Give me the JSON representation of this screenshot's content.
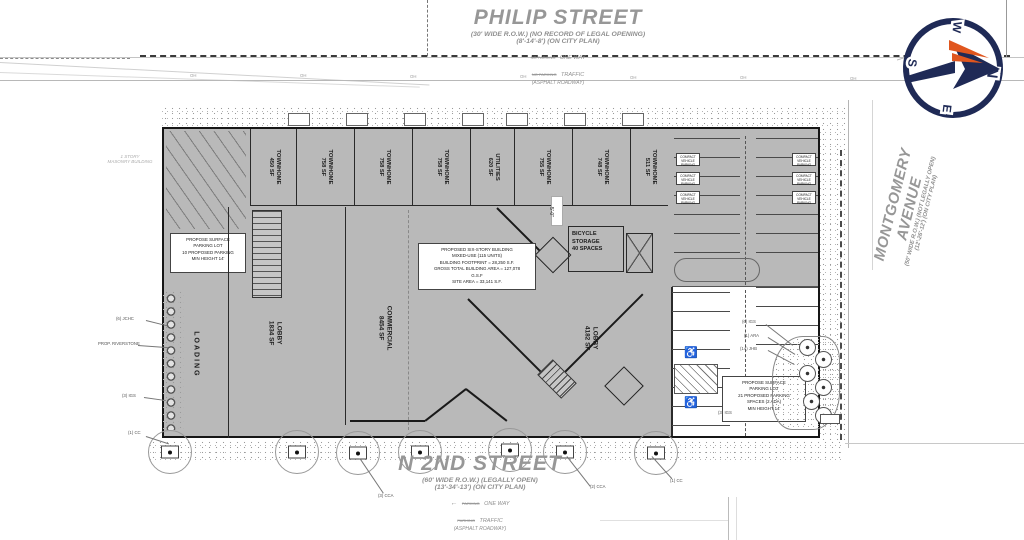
{
  "compass": {
    "n": "N",
    "e": "E",
    "s": "S",
    "w": "W"
  },
  "streets": {
    "philip": {
      "name": "PHILIP STREET",
      "row_note": "(30' WIDE R.O.W.) (NO RECORD OF LEGAL OPENING)",
      "plan_note": "(8'-14'-8') (ON CITY PLAN)",
      "parking_note_1": "NO PARKING",
      "dir_note_1": "ONE WAY",
      "parking_note_2": "NO PARKING",
      "dir_note_2": "TRAFFIC",
      "surface_note": "(ASPHALT ROADWAY)"
    },
    "n2nd": {
      "name": "N 2ND STREET",
      "row_note": "(60' WIDE R.O.W.) (LEGALLY OPEN)",
      "plan_note": "(13'-34'-13') (ON CITY PLAN)",
      "arrow": "←",
      "parking_note_1": "PARKING",
      "dir_note_1": "ONE WAY",
      "parking_note_2": "PARKING",
      "dir_note_2": "TRAFFIC",
      "surface_note": "(ASPHALT ROADWAY)"
    },
    "montgomery": {
      "name": "MONTGOMERY AVENUE",
      "row_note": "(50' WIDE R.O.W.) (NOT LEGALLY OPEN)",
      "plan_note": "(12'-26'-12') (ON CITY PLAN)"
    }
  },
  "notes": {
    "building": [
      "PROPOSED SIX-STORY BUILDING",
      "MIXED-USE (115 UNITS)",
      "BUILDING FOOTPRINT = 28,250 S.F.",
      "GROSS TOTAL BUILDING AREA = 127,078",
      "G.S.F",
      "SITE AREA = 33,141 S.F."
    ],
    "west_parking": [
      "PROPOSE SURFACE",
      "PARKING LOT",
      "10 PROPOSED PARKING",
      "MIN HEIGHT 14'"
    ],
    "east_parking": [
      "PROPOSE SURFACE",
      "PARKING LOT",
      "21 PROPOSED PARKING",
      "SPACES (2 ADA)",
      "MIN HEIGHT 14'"
    ]
  },
  "units": [
    {
      "name": "TOWNHOME",
      "area": "450 SF"
    },
    {
      "name": "TOWNHOME",
      "area": "758 SF"
    },
    {
      "name": "TOWNHOME",
      "area": "758 SF"
    },
    {
      "name": "TOWNHOME",
      "area": "758 SF"
    },
    {
      "name": "UTILITIES",
      "area": "620 SF"
    },
    {
      "name": "TOWNHOME",
      "area": "755 SF"
    },
    {
      "name": "TOWNHOME",
      "area": "748 SF"
    },
    {
      "name": "TOWNHOME",
      "area": "511 SF"
    }
  ],
  "rooms": {
    "lobby_west": {
      "name": "LOBBY",
      "area": "1834 SF"
    },
    "commercial": {
      "name": "COMMERCIAL",
      "area": "8454 SF"
    },
    "lobby_east": {
      "name": "LOBBY",
      "area": "4182 SF"
    },
    "bike": [
      "BICYCLE",
      "STORAGE",
      "40 SPACES"
    ],
    "loading": "LOADING"
  },
  "labels": {
    "dim_5ft": "5'-0\"",
    "compact": [
      "COMPACT",
      "VEHICLE",
      "PARKING"
    ],
    "jchc": "(6) JCHC",
    "riverstone": "PROP. RIVERSTONE",
    "igs_west": "(3) IGS",
    "cc_sw": "(1) CC",
    "cca_3": "(3) CCA",
    "cca_2": "(2) CCA",
    "cc_s": "(1) CC",
    "igs_6": "(6) IGS",
    "ara_1": "(1) ARA",
    "jhb_14": "(14) JHB",
    "igs_3e": "(3) IGS",
    "masonry_1": "1 STORY",
    "masonry_2": "MASONRY BUILDING",
    "oh": "OH",
    "ada": "♿"
  },
  "colors": {
    "navy": "#1f2a56",
    "orange": "#e0561e",
    "building_gray": "#b9b9b9"
  }
}
